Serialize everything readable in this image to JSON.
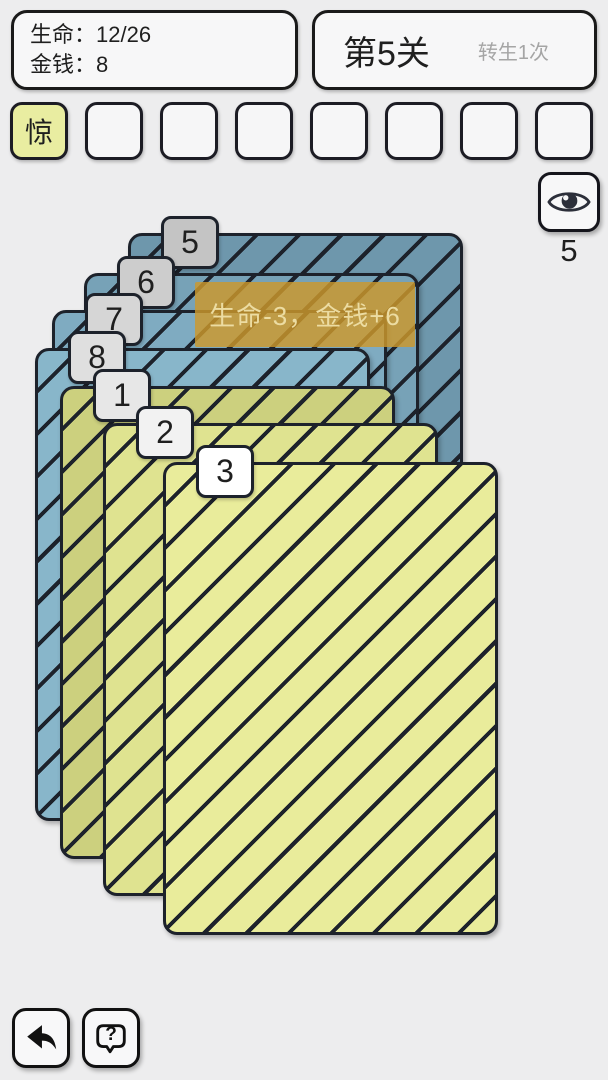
{
  "stats": {
    "life_label": "生命：",
    "life_value": "12/26",
    "money_label": "金钱：",
    "money_value": "8"
  },
  "level": {
    "title": "第5关",
    "rebirth_note": "转生1次"
  },
  "inventory": {
    "filled_color": "#e9eda1",
    "slots": [
      {
        "label": "惊",
        "filled": true
      },
      {
        "label": "",
        "filled": false
      },
      {
        "label": "",
        "filled": false
      },
      {
        "label": "",
        "filled": false
      },
      {
        "label": "",
        "filled": false
      },
      {
        "label": "",
        "filled": false
      },
      {
        "label": "",
        "filled": false
      },
      {
        "label": "",
        "filled": false
      }
    ]
  },
  "peek": {
    "icon": "eye-icon",
    "count": "5"
  },
  "effect_banner": {
    "text": "生命-3，金钱+6",
    "bg_color": "rgba(205,152,44,0.82)",
    "text_color": "#ecdca2"
  },
  "cards": [
    {
      "number": "5",
      "type": "blue",
      "color": "#6e97ac",
      "tab_color": "#c4c4c4"
    },
    {
      "number": "6",
      "type": "blue",
      "color": "#77a2b7",
      "tab_color": "#cdcdcd"
    },
    {
      "number": "7",
      "type": "blue",
      "color": "#7fabc1",
      "tab_color": "#d6d6d6"
    },
    {
      "number": "8",
      "type": "blue",
      "color": "#88b6ca",
      "tab_color": "#dfdfdf"
    },
    {
      "number": "1",
      "type": "yellow",
      "color": "#ccd07e",
      "tab_color": "#e7e7e7"
    },
    {
      "number": "2",
      "type": "yellow",
      "color": "#dfe390",
      "tab_color": "#f2f2f2"
    },
    {
      "number": "3",
      "type": "yellow",
      "color": "#e9ec9b",
      "tab_color": "#ffffff"
    }
  ],
  "stripe_color": "#1d222b",
  "footer": {
    "back_icon": "back-arrow-icon",
    "help_icon": "help-bubble-icon",
    "help_glyph": "?"
  }
}
